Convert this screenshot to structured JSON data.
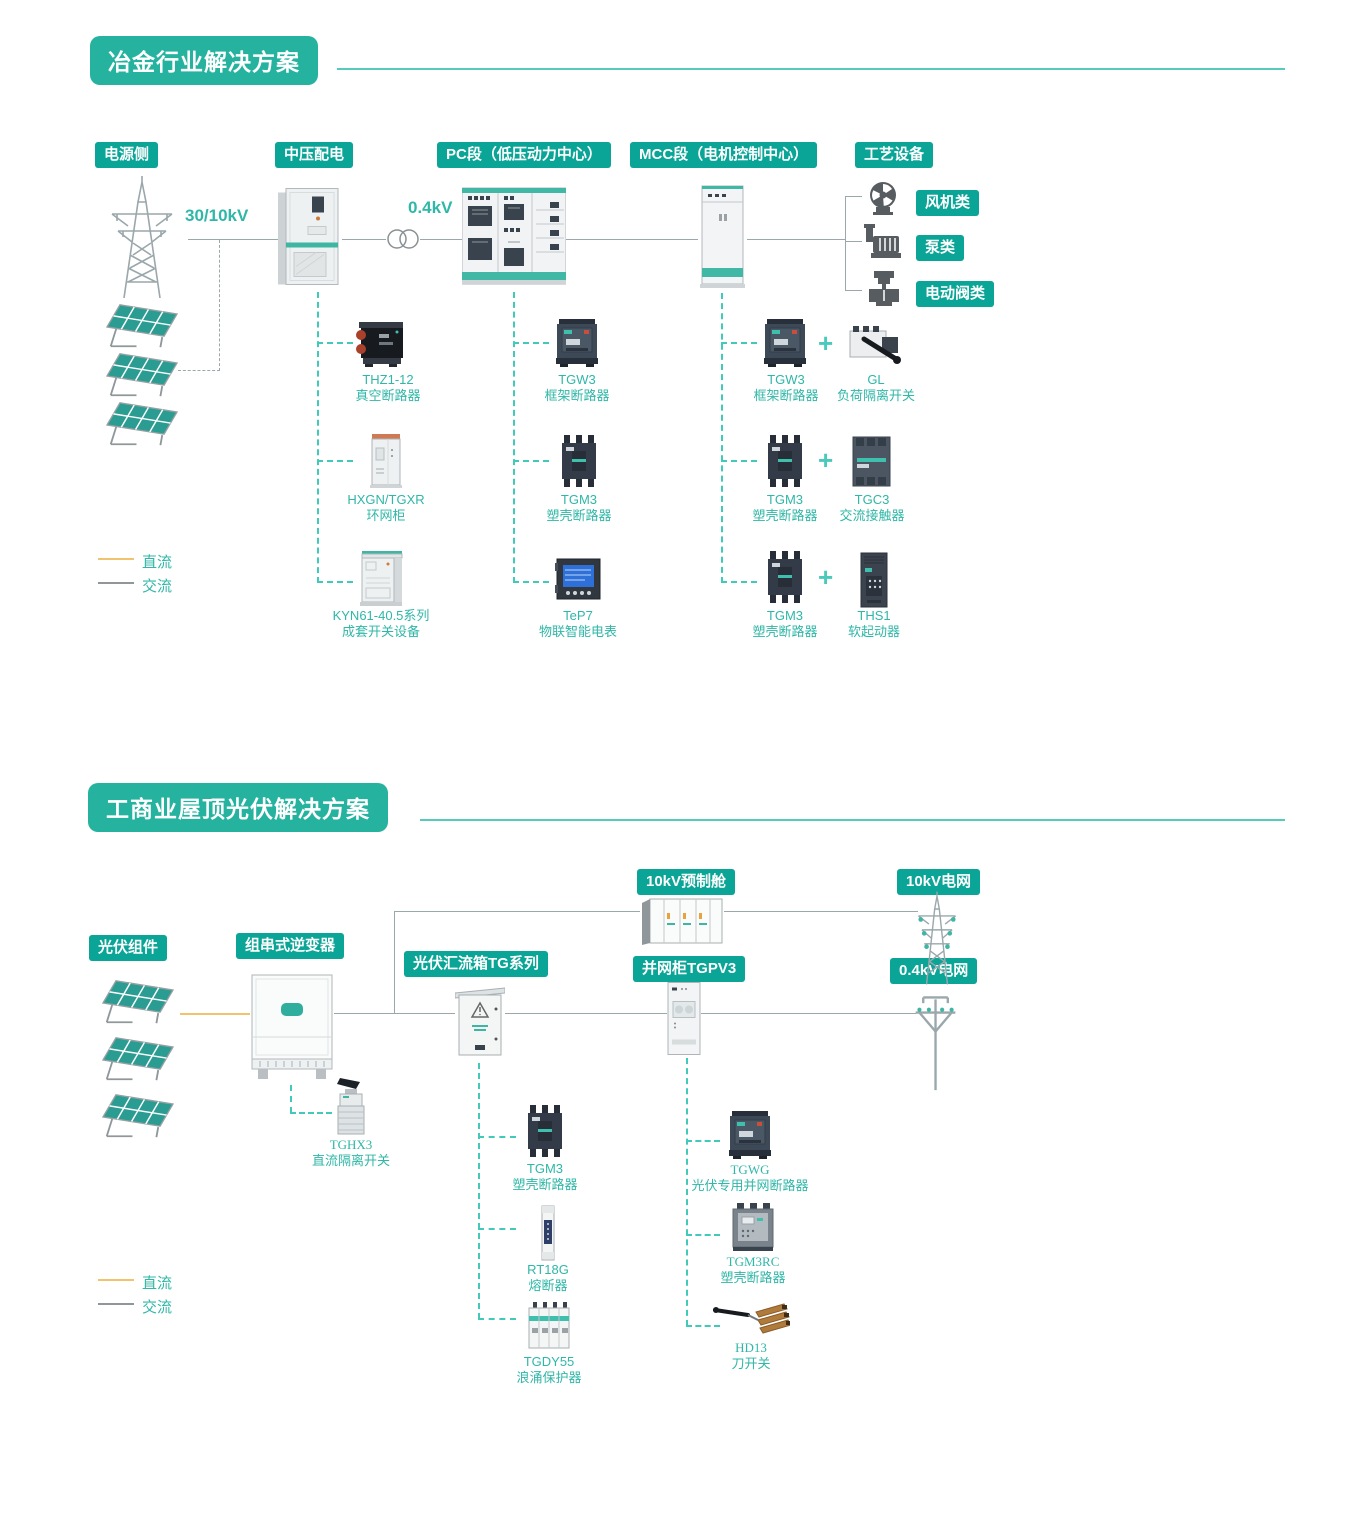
{
  "colors": {
    "accent_teal": "#0aa596",
    "badge_teal": "#25b39f",
    "label_text_teal": "#2fb7a7",
    "dashed_teal": "#41c9ba",
    "dc_line_orange": "#f2c36e",
    "ac_line_gray": "#9aa7ab"
  },
  "section1": {
    "title": "冶金行业解决方案",
    "labels": {
      "power_side": "电源侧",
      "mv": "中压配电",
      "pc": "PC段（低压动力中心）",
      "mcc": "MCC段（电机控制中心）",
      "process": "工艺设备",
      "fan": "风机类",
      "pump": "泵类",
      "valve": "电动阀类"
    },
    "voltages": {
      "hv": "30/10kV",
      "lv": "0.4kV"
    },
    "legend": {
      "dc": "直流",
      "ac": "交流"
    },
    "plus": "+",
    "mv_products": [
      {
        "model": "THZ1-12",
        "desc": "真空断路器"
      },
      {
        "model": "HXGN/TGXR",
        "desc": "环网柜"
      },
      {
        "model": "KYN61-40.5系列",
        "desc": "成套开关设备"
      }
    ],
    "pc_products": [
      {
        "model": "TGW3",
        "desc": "框架断路器"
      },
      {
        "model": "TGM3",
        "desc": "塑壳断路器"
      },
      {
        "model": "TeP7",
        "desc": "物联智能电表"
      }
    ],
    "mcc_pairs": [
      {
        "left": {
          "model": "TGW3",
          "desc": "框架断路器"
        },
        "right": {
          "model": "GL",
          "desc": "负荷隔离开关"
        }
      },
      {
        "left": {
          "model": "TGM3",
          "desc": "塑壳断路器"
        },
        "right": {
          "model": "TGC3",
          "desc": "交流接触器"
        }
      },
      {
        "left": {
          "model": "TGM3",
          "desc": "塑壳断路器"
        },
        "right": {
          "model": "THS1",
          "desc": "软起动器"
        }
      }
    ]
  },
  "section2": {
    "title": "工商业屋顶光伏解决方案",
    "labels": {
      "pv": "光伏组件",
      "inverter": "组串式逆变器",
      "combiner": "光伏汇流箱TG系列",
      "grid_cabinet": "并网柜TGPV3",
      "prefab": "10kV预制舱",
      "grid_10kv": "10kV电网",
      "grid_04kv": "0.4kV电网"
    },
    "legend": {
      "dc": "直流",
      "ac": "交流"
    },
    "inverter_product": {
      "model": "TGHX3",
      "desc": "直流隔离开关"
    },
    "combiner_products": [
      {
        "model": "TGM3",
        "desc": "塑壳断路器"
      },
      {
        "model": "RT18G",
        "desc": "熔断器"
      },
      {
        "model": "TGDY55",
        "desc": "浪涌保护器"
      }
    ],
    "grid_products": [
      {
        "model": "TGWG",
        "desc": "光伏专用并网断路器"
      },
      {
        "model": "TGM3RC",
        "desc": "塑壳断路器"
      },
      {
        "model": "HD13",
        "desc": "刀开关"
      }
    ]
  }
}
